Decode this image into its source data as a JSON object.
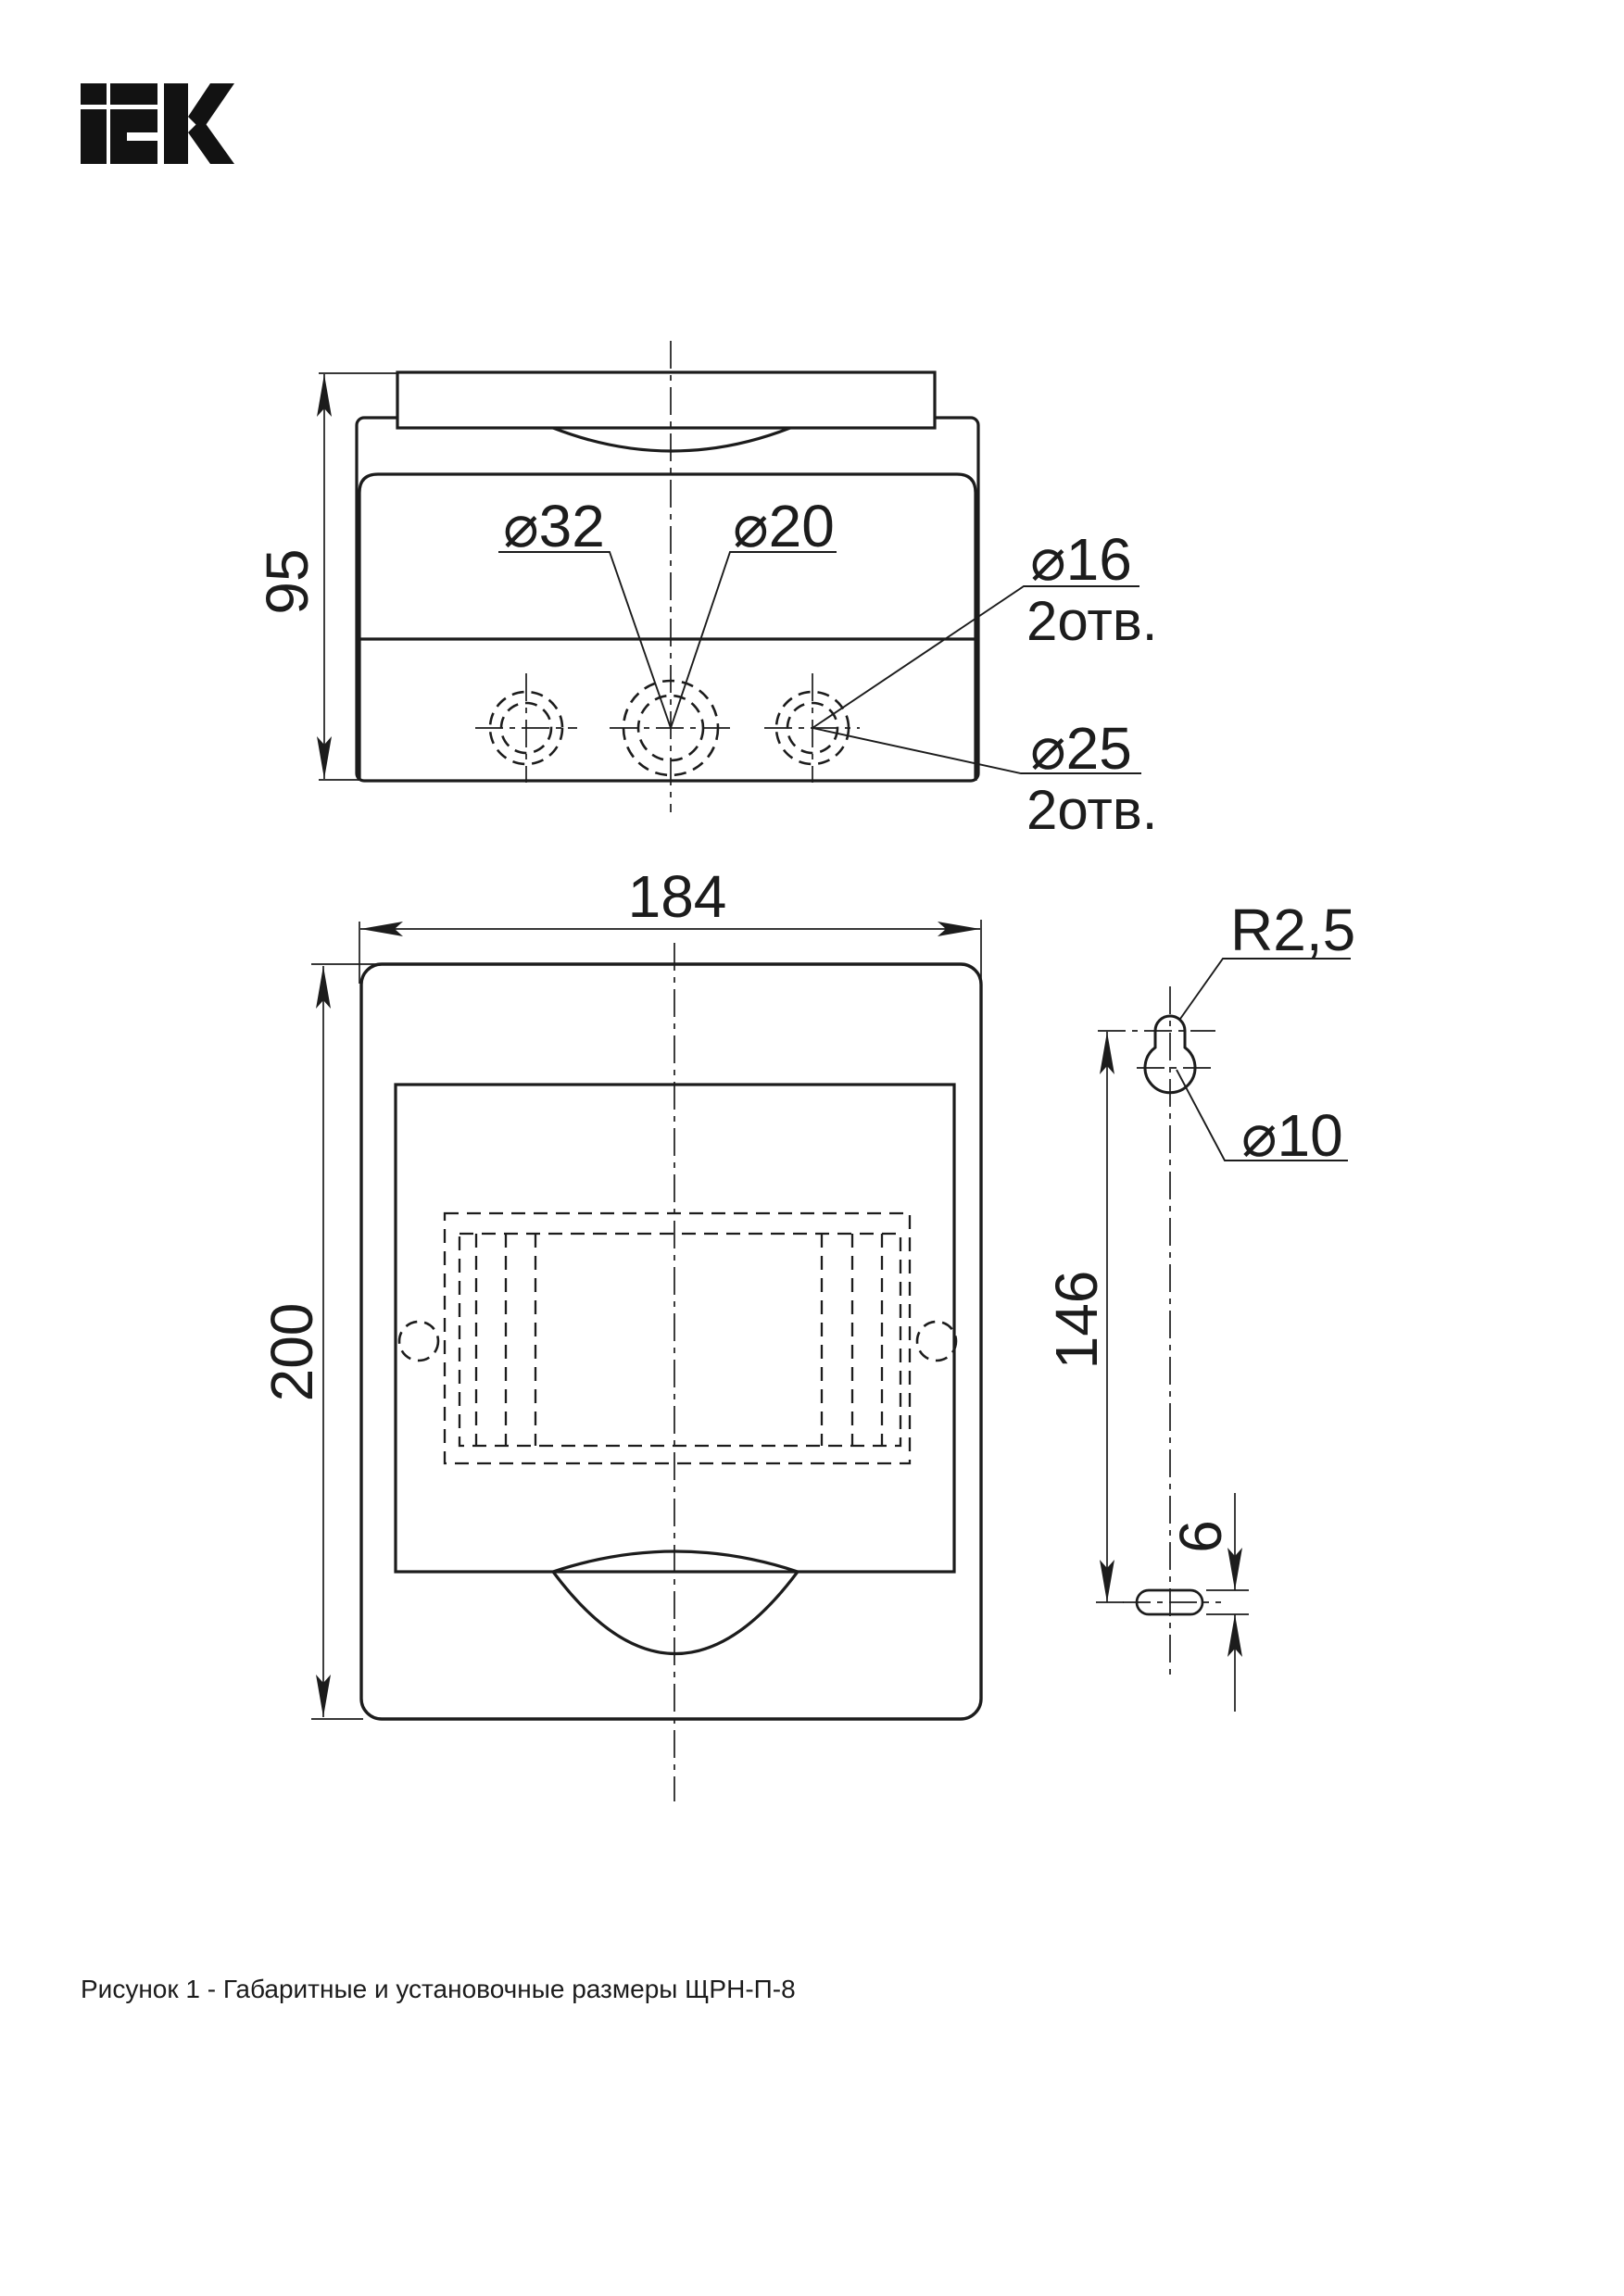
{
  "colors": {
    "line": "#1c1c1c",
    "background": "#ffffff"
  },
  "logo": {
    "brand": "IEK"
  },
  "top_view": {
    "height_dim": "95",
    "hole_labels": {
      "d32": "⌀32",
      "d20": "⌀20",
      "d16": "⌀16",
      "d16_qty": "2отв.",
      "d25": "⌀25",
      "d25_qty": "2отв."
    }
  },
  "front_view": {
    "width_dim": "184",
    "height_dim": "200"
  },
  "mounting_detail": {
    "radius_dim": "R2,5",
    "hole_dim": "⌀10",
    "vertical_spacing_dim": "146",
    "slot_height_dim": "6"
  },
  "caption": "Рисунок 1 - Габаритные и установочные размеры ЩРН-П-8"
}
